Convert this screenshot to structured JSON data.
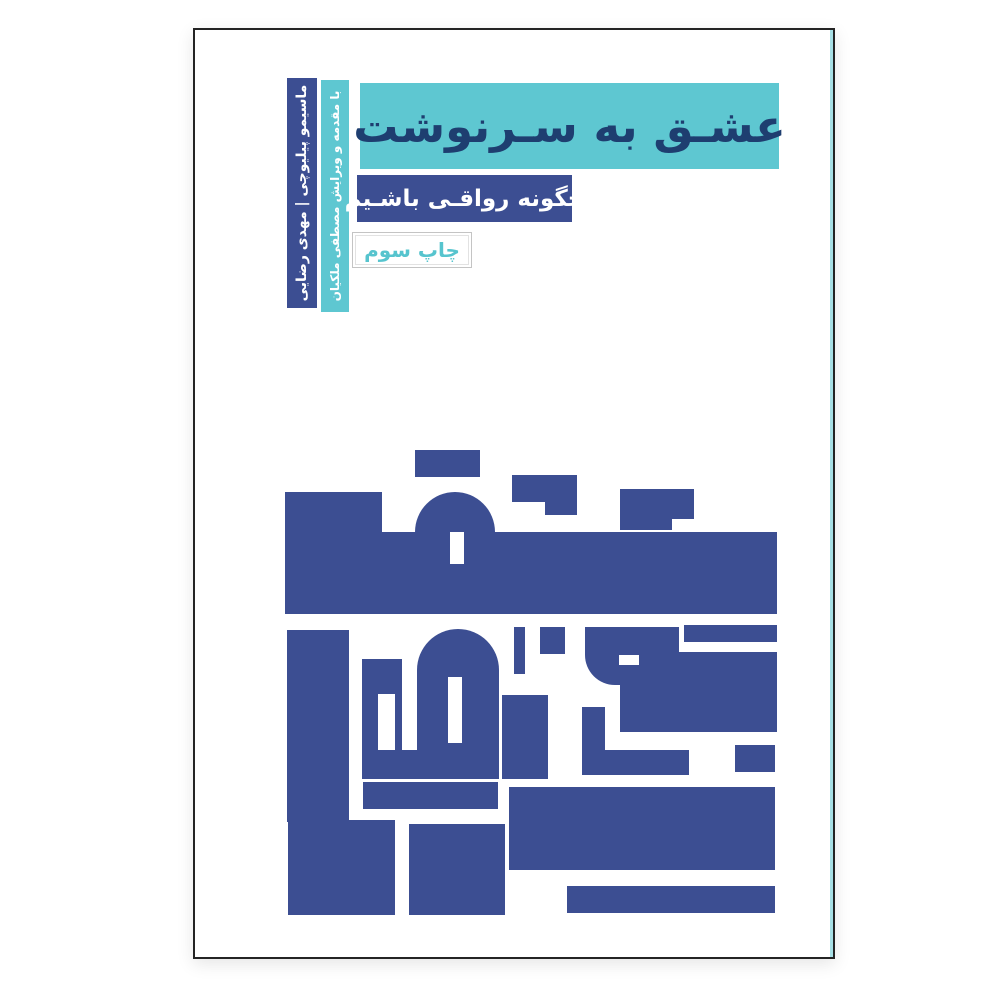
{
  "colors": {
    "ink": "#3c4e92",
    "teal": "#5ec7d1",
    "teal_text": "#56c4ce",
    "title_ink": "#1e3e70",
    "cover_bg": "#ffffff"
  },
  "banner": {
    "title": "عشـق به سـرنوشت"
  },
  "subtitle": {
    "text": "چگونه رواقـی باشـیم"
  },
  "edition": {
    "text": "چاپ سوم"
  },
  "spine": {
    "authors": "ماسیمو پیلیوچی | مهدی رضایی",
    "editor_note": "با مقدمه و ویرایش مصطفی ملکیان"
  },
  "artwork": {
    "description": "square-kufic-calligraphy-of-title",
    "viewbox": "0 0 492 465",
    "shapes": [
      {
        "t": "r",
        "x": 130,
        "y": 0,
        "w": 65,
        "h": 27
      },
      {
        "t": "r",
        "x": 227,
        "y": 25,
        "w": 65,
        "h": 27
      },
      {
        "t": "r",
        "x": 260,
        "y": 52,
        "w": 32,
        "h": 13
      },
      {
        "t": "r",
        "x": 335,
        "y": 39,
        "w": 74,
        "h": 30
      },
      {
        "t": "r",
        "x": 335,
        "y": 69,
        "w": 52,
        "h": 11
      },
      {
        "t": "r",
        "x": 0,
        "y": 42,
        "w": 97,
        "h": 42
      },
      {
        "t": "r",
        "x": 0,
        "y": 82,
        "w": 492,
        "h": 82
      },
      {
        "t": "p",
        "d": "M130,164 V82 A40,40 0 0 1 210,82 V164 Z"
      },
      {
        "t": "r",
        "x": 165,
        "y": 82,
        "w": 14,
        "h": 32,
        "f": "w"
      },
      {
        "t": "r",
        "x": 2,
        "y": 180,
        "w": 62,
        "h": 192
      },
      {
        "t": "r",
        "x": 77,
        "y": 209,
        "w": 40,
        "h": 120
      },
      {
        "t": "r",
        "x": 93,
        "y": 244,
        "w": 17,
        "h": 65,
        "f": "w"
      },
      {
        "t": "p",
        "d": "M132,329 V220 A41,41 0 0 1 214,220 V329 Z"
      },
      {
        "t": "r",
        "x": 163,
        "y": 227,
        "w": 14,
        "h": 66,
        "f": "w"
      },
      {
        "t": "r",
        "x": 77,
        "y": 300,
        "w": 137,
        "h": 29
      },
      {
        "t": "r",
        "x": 229,
        "y": 177,
        "w": 11,
        "h": 47
      },
      {
        "t": "r",
        "x": 255,
        "y": 177,
        "w": 25,
        "h": 27
      },
      {
        "t": "p",
        "d": "M300,177 H394 V235 H330 A30,30 0 0 1 300,205 Z"
      },
      {
        "t": "r",
        "x": 334,
        "y": 205,
        "w": 20,
        "h": 10,
        "f": "w"
      },
      {
        "t": "r",
        "x": 399,
        "y": 175,
        "w": 93,
        "h": 17
      },
      {
        "t": "p",
        "d": "M389,202 H492 V282 H335 V235 H389 Z"
      },
      {
        "t": "r",
        "x": 217,
        "y": 245,
        "w": 46,
        "h": 84
      },
      {
        "t": "r",
        "x": 297,
        "y": 257,
        "w": 23,
        "h": 48
      },
      {
        "t": "r",
        "x": 297,
        "y": 300,
        "w": 107,
        "h": 25
      },
      {
        "t": "r",
        "x": 450,
        "y": 295,
        "w": 40,
        "h": 27
      },
      {
        "t": "r",
        "x": 3,
        "y": 370,
        "w": 107,
        "h": 95
      },
      {
        "t": "r",
        "x": 78,
        "y": 332,
        "w": 135,
        "h": 27
      },
      {
        "t": "r",
        "x": 124,
        "y": 374,
        "w": 96,
        "h": 91
      },
      {
        "t": "r",
        "x": 224,
        "y": 337,
        "w": 266,
        "h": 83
      },
      {
        "t": "r",
        "x": 282,
        "y": 436,
        "w": 208,
        "h": 27
      }
    ]
  }
}
